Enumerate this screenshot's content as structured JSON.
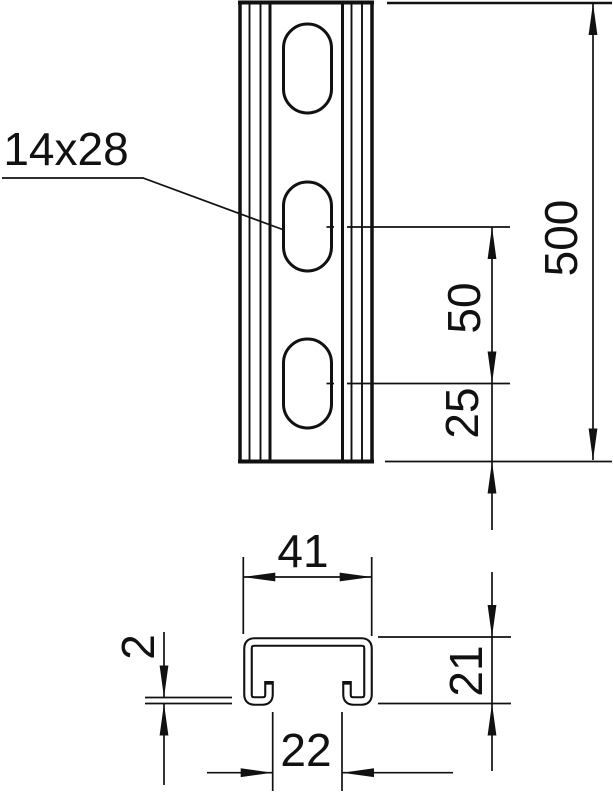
{
  "title": "Profile rail technical drawing",
  "colors": {
    "line": "#111111",
    "background": "#ffffff"
  },
  "front_view": {
    "leader_label": "14x28",
    "dim_length": "500",
    "dim_hole_spacing": "50",
    "dim_end_offset": "25"
  },
  "section_view": {
    "dim_width": "41",
    "dim_height": "21",
    "dim_thickness": "2",
    "dim_opening": "22"
  }
}
